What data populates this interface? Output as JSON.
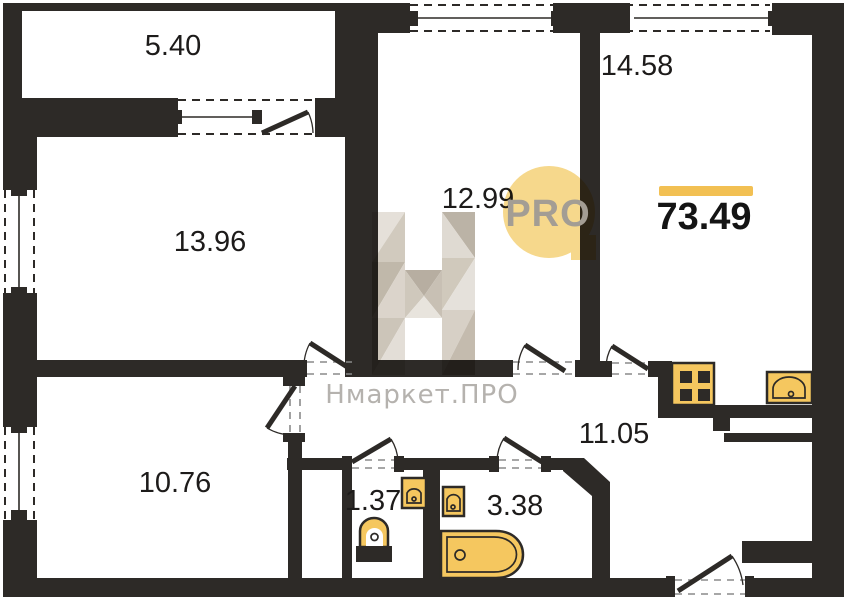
{
  "plan": {
    "total_area": "73.49",
    "rooms": [
      {
        "name": "loggia",
        "area": "5.40"
      },
      {
        "name": "room-13-96",
        "area": "13.96"
      },
      {
        "name": "room-12-99",
        "area": "12.99"
      },
      {
        "name": "room-14-58",
        "area": "14.58"
      },
      {
        "name": "room-10-76",
        "area": "10.76"
      },
      {
        "name": "hallway-11-05",
        "area": "11.05"
      },
      {
        "name": "wc",
        "area": "1.37"
      },
      {
        "name": "bathroom",
        "area": "3.38"
      }
    ]
  },
  "watermark": {
    "brand": "Нмаркет.ПРО",
    "logo_text": "PRO"
  },
  "colors": {
    "wall": "#2d2a27",
    "accent": "#f2c053",
    "fixture": "#f5c75f",
    "logo": "#f6d88c",
    "logo_text": "#a39d94",
    "brand_text": "#b5b2ae",
    "label": "#1d1b1a"
  }
}
